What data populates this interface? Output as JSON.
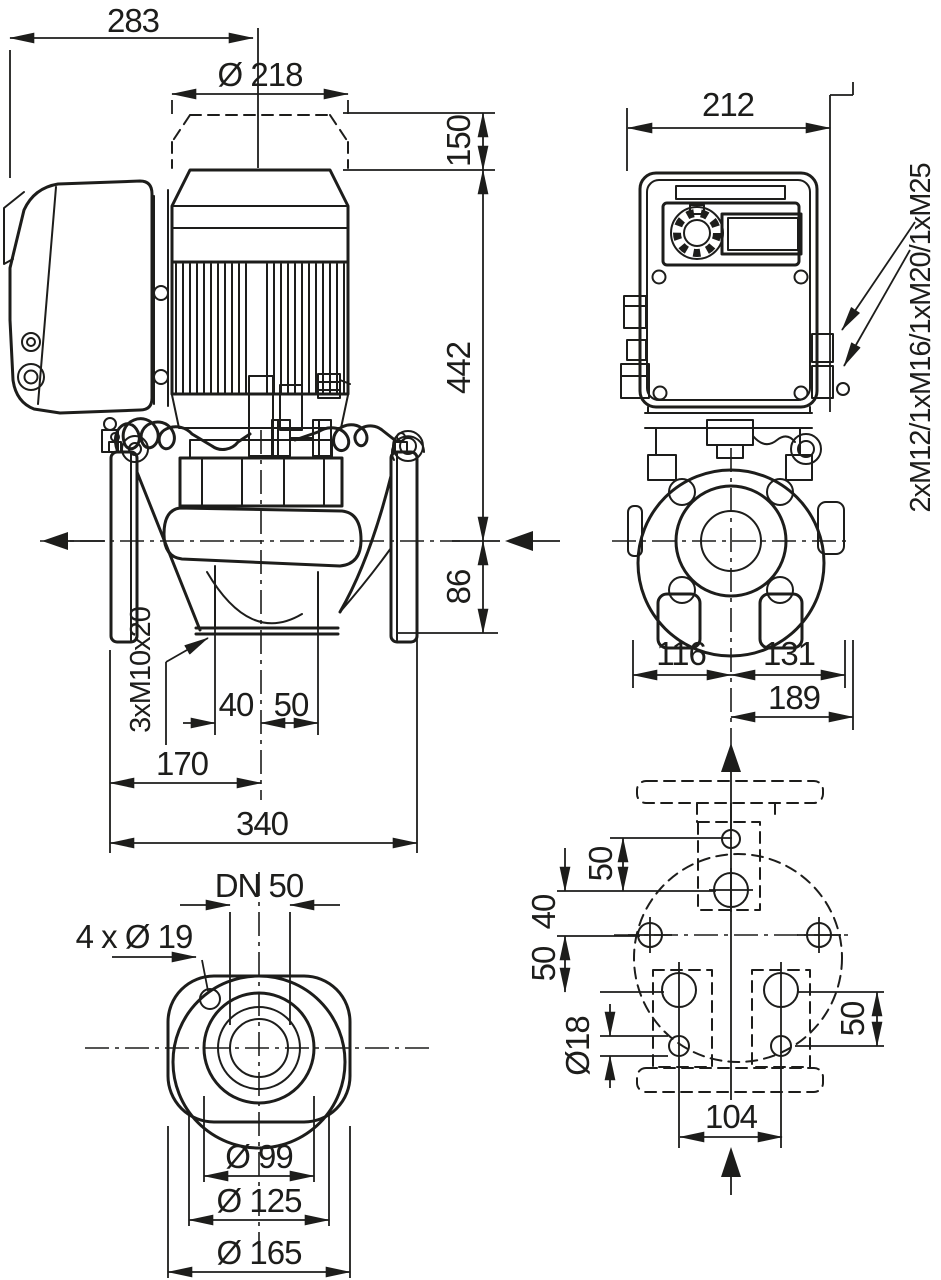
{
  "drawing": {
    "type": "pump-dimensional-drawing",
    "line_color": "#1d1d1b",
    "background": "#ffffff",
    "side_view": {
      "dim_overall_width": "283",
      "dim_motor_diameter": "Ø 218",
      "dim_removal_clearance": "150",
      "dim_height_above_axis": "442",
      "dim_height_below_axis": "86",
      "label_foot_threads": "3xM10x20",
      "dim_foot_hole_offset_left": "40",
      "dim_foot_hole_offset_right": "50",
      "dim_suction_face_to_axis": "170",
      "dim_flange_to_flange": "340"
    },
    "front_view": {
      "dim_module_width": "212",
      "dim_axis_to_left": "116",
      "dim_axis_to_right": "131",
      "dim_axis_to_module_edge": "189",
      "label_cable_glands": "2xM12/1xM16/1xM20/1xM25"
    },
    "flange_view": {
      "label_nominal_diameter": "DN 50",
      "label_bolt_holes": "4 x Ø 19",
      "dim_raised_face_diameter": "Ø 99",
      "dim_bolt_circle_diameter": "Ø 125",
      "dim_flange_outer_diameter": "Ø 165"
    },
    "bottom_view": {
      "dim_hole_row_top": "50",
      "dim_hole_row_mid": "40",
      "dim_hole_row_low": "50",
      "dim_hole_row_right": "50",
      "dim_base_hole_diameter": "Ø18",
      "dim_foot_hole_spacing": "104"
    }
  }
}
